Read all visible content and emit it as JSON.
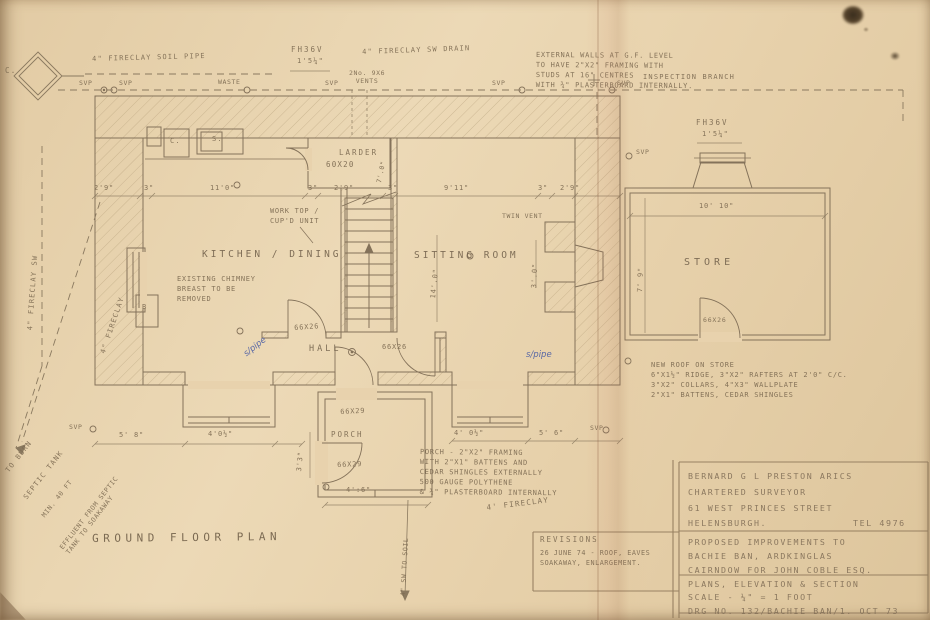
{
  "colors": {
    "paper": "#e7d1ac",
    "pencil": "#7e6c53",
    "ink_blue": "#4d5fa5"
  },
  "rooms": {
    "kitchen": "KITCHEN / DINING",
    "sitting": "SITTING ROOM",
    "hall": "HALL",
    "larder": "LARDER",
    "larder_size": "60X20",
    "porch": "PORCH",
    "store": "STORE",
    "title": "GROUND FLOOR PLAN"
  },
  "doors": {
    "d66x26": "66X26",
    "d66x29": "66X29"
  },
  "fixtures": {
    "c": "C.",
    "s": "S.",
    "b": "B"
  },
  "flues": {
    "fh36v": "FH36V",
    "fh36v_dim": "1'5¼\""
  },
  "drains": {
    "c_node": "C.",
    "soil_pipe_label": "4\" FIRECLAY SOIL PIPE",
    "sw_drain_label": "4\" FIRECLAY SW DRAIN",
    "sw_left_label": "4\" FIRECLAY SW",
    "fireclay_left_label": "4\" FIRECLAY",
    "fireclay_hand": "4' FIRECLAY",
    "sw_to_soil": "4\" SW TO SOIL",
    "inspection_branch": "INSPECTION BRANCH",
    "vents_label": "2No. 9X6\nVENTS",
    "svp": "SVP",
    "waste": "WASTE",
    "s_pipe": "s/pipe",
    "to_burn": "TO BURN",
    "septic_tank": "SEPTIC TANK",
    "min_40ft": "MIN. 40 FT",
    "effluent": "EFFLUENT FROM SEPTIC\nTANK TO SOAKAWAY"
  },
  "notes": {
    "external_walls": "EXTERNAL WALLS AT G.F. LEVEL\nTO HAVE 2\"X2\" FRAMING WITH\nSTUDS AT 16\" CENTRES\nWITH ¾\" PLASTERBOARD INTERNALLY.",
    "store_roof": "NEW ROOF ON STORE\n6\"X1½\" RIDGE, 3\"X2\" RAFTERS AT 2'0\" C/C.\n3\"X2\" COLLARS, 4\"X3\" WALLPLATE\n2\"X1\" BATTENS, CEDAR SHINGLES",
    "porch_construction": "PORCH - 2\"X2\" FRAMING\nWITH 2\"X1\" BATTENS AND\nCEDAR SHINGLES EXTERNALLY\n500 GAUGE POLYTHENE\n& ¾\" PLASTERBOARD INTERNALLY",
    "chimney_removal": "EXISTING CHIMNEY\nBREAST TO BE\nREMOVED",
    "work_top": "WORK TOP /\nCUP'D UNIT",
    "twin_vent": "TWIN VENT"
  },
  "dims": {
    "top": [
      "2'9\"",
      "3\"",
      "11'0\"",
      "3\"",
      "2'9\"",
      "3\"",
      "9'11\"",
      "3\"",
      "2'9\""
    ],
    "d5_8": "5' 8\"",
    "d4_0h": "4'0½\"",
    "d3_3": "3'3\"",
    "d4_0h2": "4' 0½\"",
    "d5_6": "5' 6\"",
    "d4_6": "4':6\"",
    "d14_0": "14'.0\"",
    "d3_0": "3'.0\"",
    "d7_0": "7'.0\"",
    "store_w": "10' 10\"",
    "store_h": "7' 9\""
  },
  "revisions": {
    "title": "REVISIONS",
    "entry": "26 JUNE 74 - ROOF, EAVES\nSOAKAWAY, ENLARGEMENT."
  },
  "titleblock": {
    "surveyor_name": "BERNARD G L PRESTON ARICS",
    "surveyor_role": "CHARTERED SURVEYOR",
    "surveyor_addr1": "61 WEST PRINCES STREET",
    "surveyor_addr2": "HELENSBURGH.",
    "surveyor_tel": "TEL 4976",
    "project": "PROPOSED IMPROVEMENTS TO\nBACHIE BAN, ARDKINGLAS\nCAIRNDOW FOR JOHN COBLE ESQ.",
    "drawing": "PLANS, ELEVATION & SECTION\nSCALE - ¼\" = 1 FOOT\nDRG NO. 132/BACHIE BAN/1. OCT 73"
  }
}
